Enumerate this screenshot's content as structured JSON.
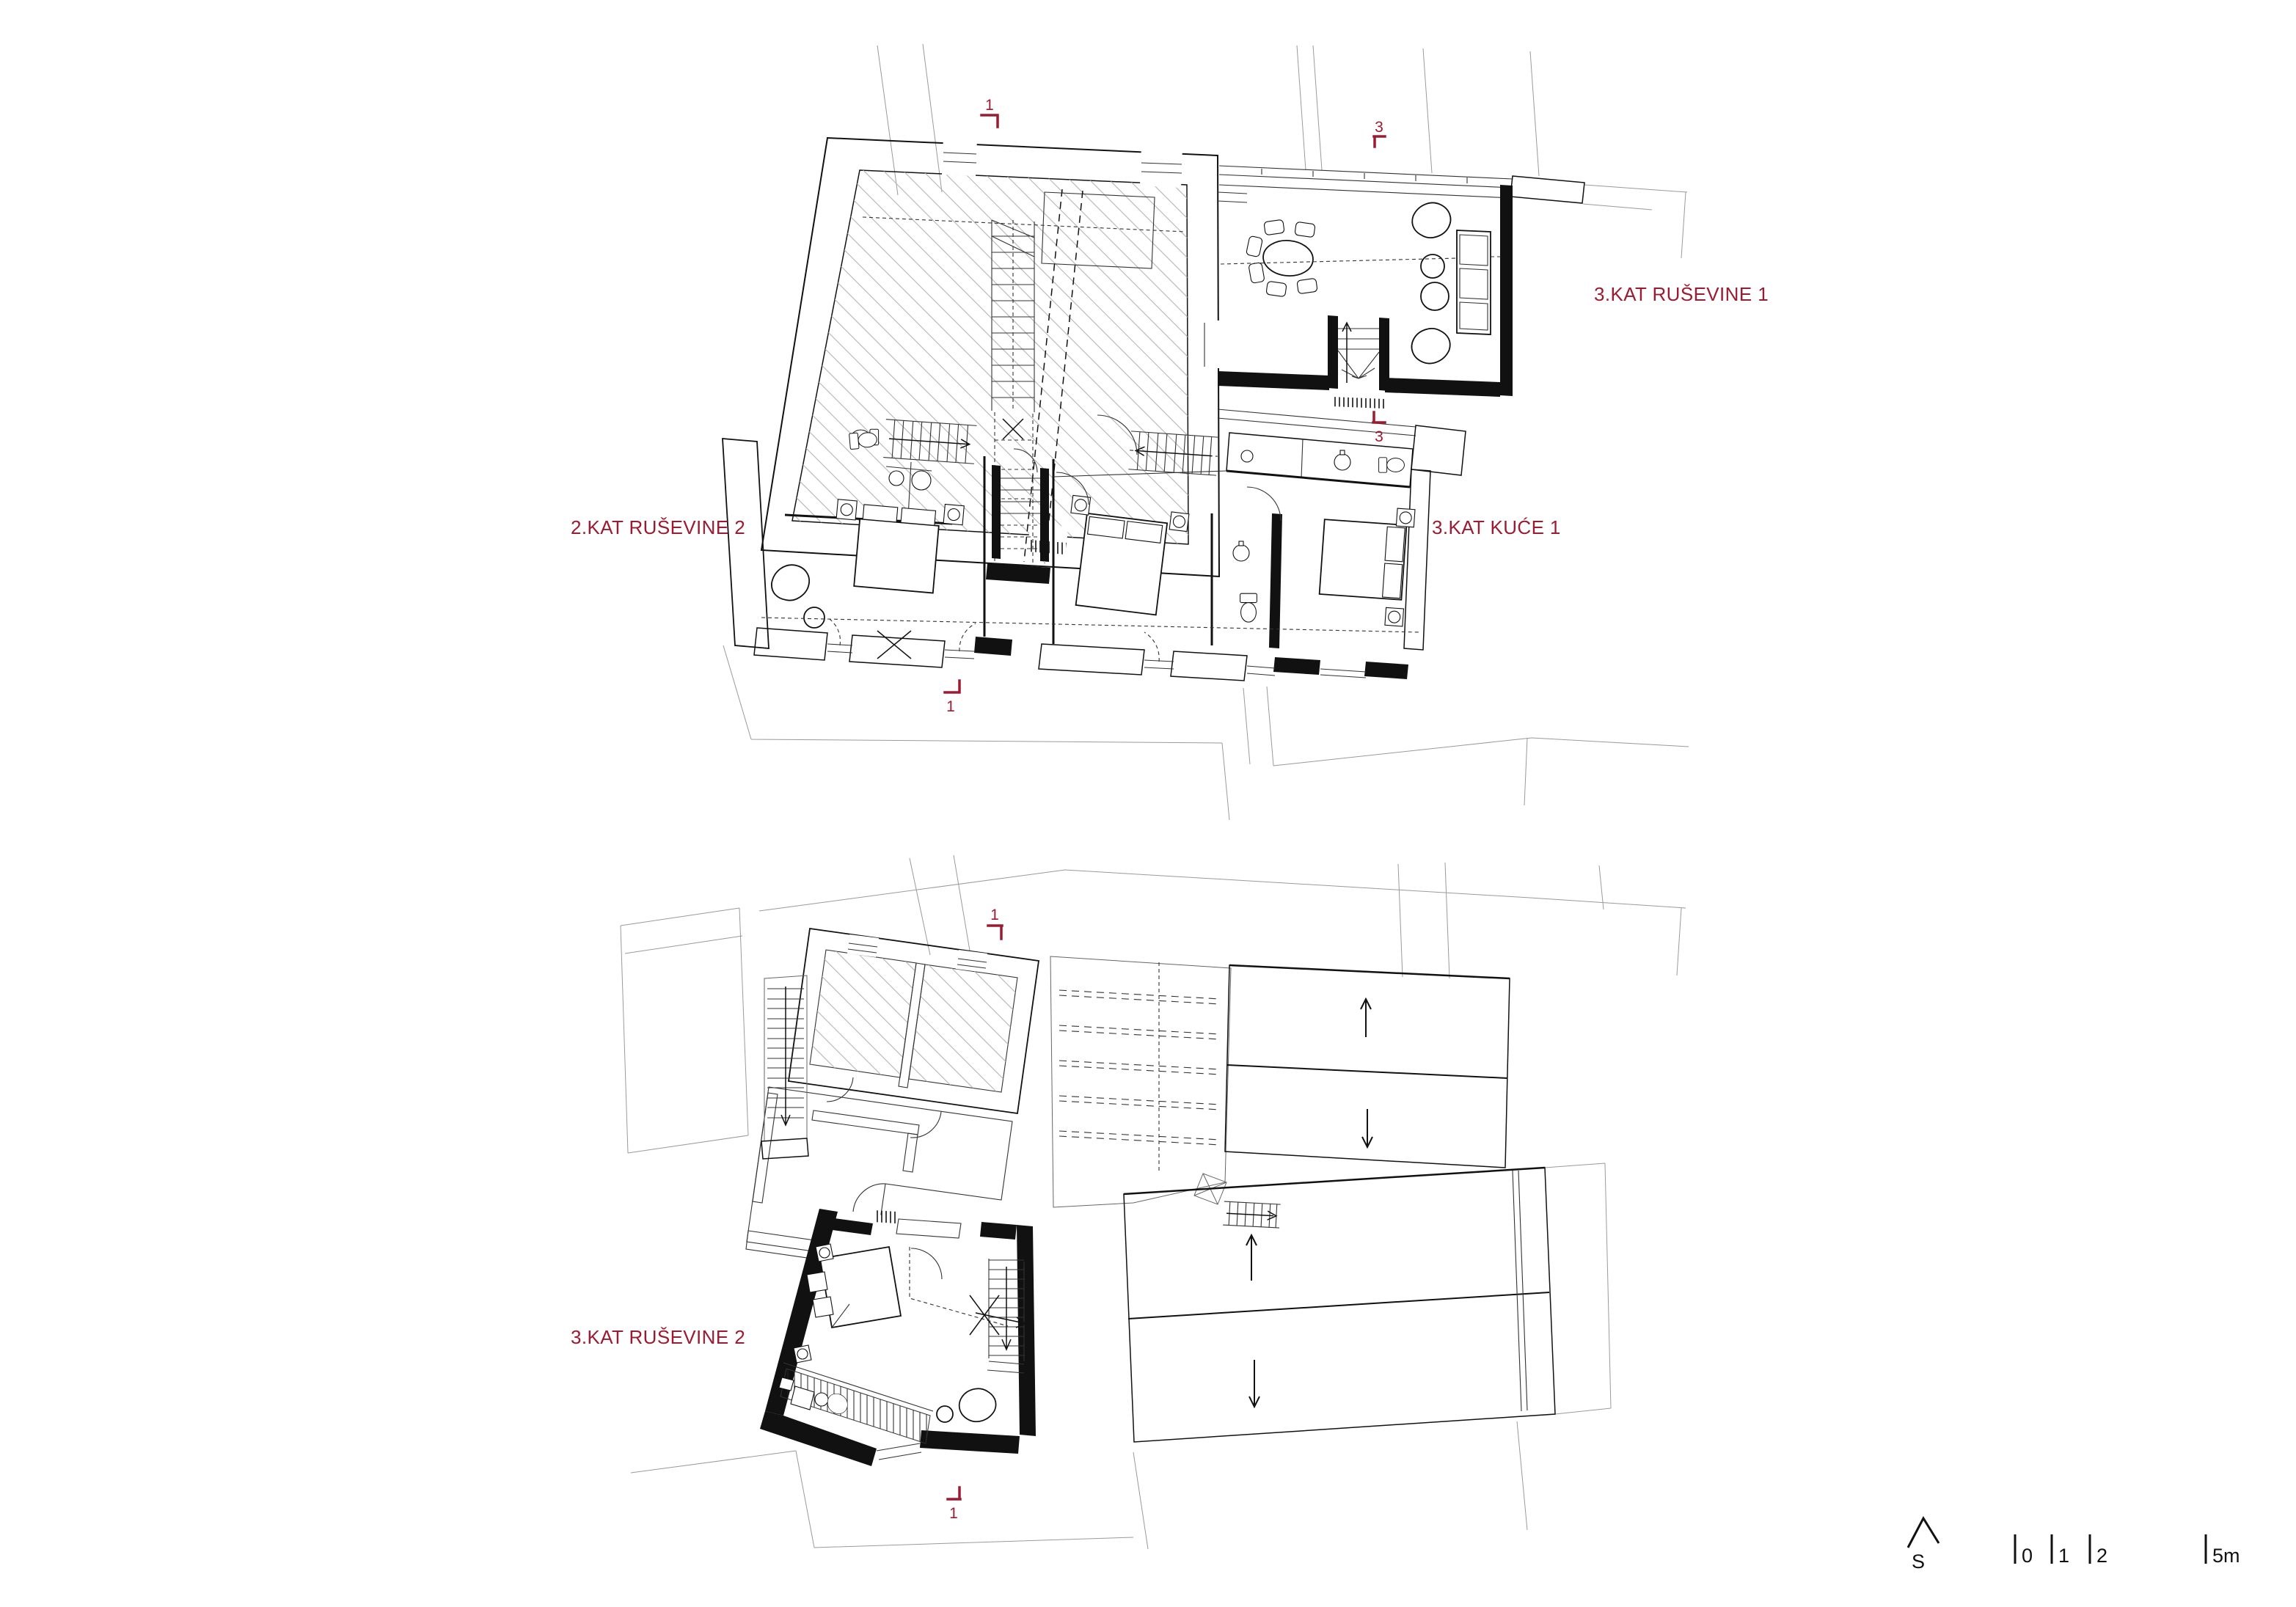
{
  "colors": {
    "accent": "#9B1B30",
    "ink": "#111111",
    "ctx": "#9a9a9a"
  },
  "plan_top": {
    "label_left": "2.KAT RUŠEVINE 2",
    "label_right": "3.KAT RUŠEVINE 1",
    "label_mid_right": "3.KAT KUĆE 1",
    "markers": {
      "sec1_top": "1",
      "sec1_bottom": "1",
      "sec3_top": "3",
      "sec3_bottom": "3"
    }
  },
  "plan_bottom": {
    "label_left": "3.KAT RUŠEVINE 2",
    "markers": {
      "sec1_top": "1",
      "sec1_bottom": "1"
    }
  },
  "legend": {
    "north_label": "S",
    "scale_ticks": [
      "0",
      "1",
      "2",
      "5m"
    ]
  }
}
